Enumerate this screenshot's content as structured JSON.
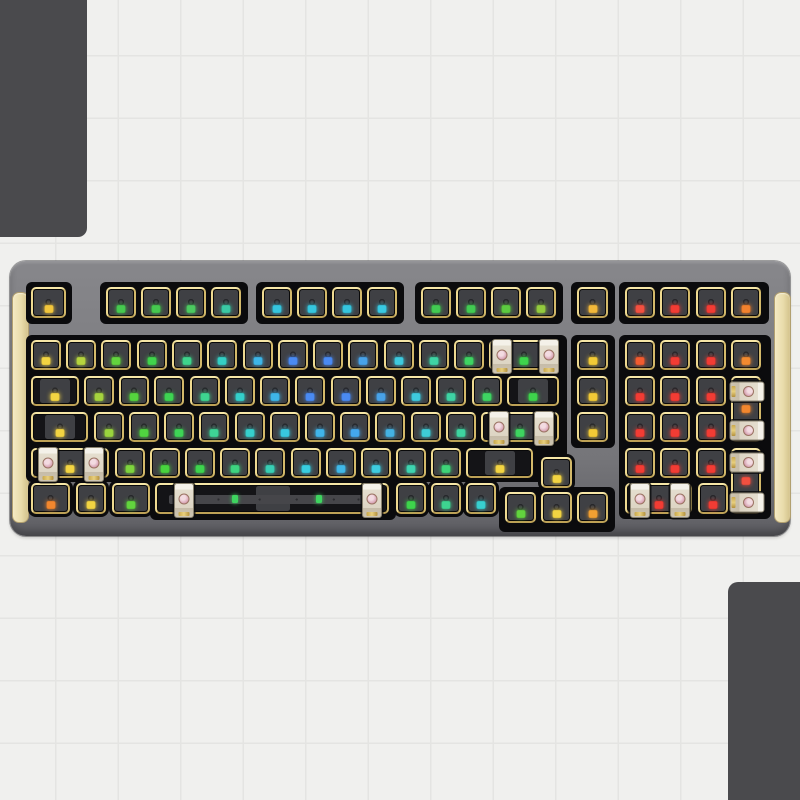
{
  "scene": {
    "background_color": "#f0f0ee",
    "grid_line_color": "#e4e4e2",
    "grid_size_px": 62.5,
    "grid_offset_px": 55,
    "corner_block_color": "#4a4a4d",
    "corner_blocks": [
      {
        "id": "top-left",
        "x": 0,
        "y": 0,
        "w": 87,
        "h": 237,
        "corner": "tl"
      },
      {
        "id": "bottom-right",
        "x": 728,
        "y": 582,
        "w": 72,
        "h": 218,
        "corner": "br"
      }
    ]
  },
  "keyboard": {
    "description": "barebone hot-swap keyboard kit, 98-key layout, gray case, gold plate, per-key RGB leds, stabilizers pre-installed",
    "x": 10,
    "y": 261,
    "w": 780,
    "h": 275,
    "case_color": "#7d7d81",
    "plate_gold_color": "#ead687",
    "pcb_black_color": "#0b0b0d",
    "switch_cutout_color": "#3f4044",
    "accent_color": "#e9dcab",
    "stabilizer_body_color": "#e5decf",
    "stabilizer_center_color": "#d49cae",
    "side_accents": [
      {
        "id": "left-side-accent",
        "x": 2,
        "y": 31,
        "w": 15,
        "h": 229
      },
      {
        "id": "right-side-accent",
        "x": 764,
        "y": 31,
        "w": 15,
        "h": 229
      }
    ],
    "pcb_panels": [
      {
        "x": 16,
        "y": 21,
        "w": 46,
        "h": 42
      },
      {
        "x": 90,
        "y": 21,
        "w": 148,
        "h": 42
      },
      {
        "x": 246,
        "y": 21,
        "w": 148,
        "h": 42
      },
      {
        "x": 405,
        "y": 21,
        "w": 148,
        "h": 42
      },
      {
        "x": 561,
        "y": 21,
        "w": 44,
        "h": 42
      },
      {
        "x": 609,
        "y": 21,
        "w": 150,
        "h": 42
      },
      {
        "x": 16,
        "y": 74,
        "w": 541,
        "h": 147
      },
      {
        "x": 561,
        "y": 74,
        "w": 44,
        "h": 113
      },
      {
        "x": 609,
        "y": 74,
        "w": 152,
        "h": 184
      },
      {
        "x": 140,
        "y": 217,
        "w": 246,
        "h": 42
      },
      {
        "x": 489,
        "y": 226,
        "w": 116,
        "h": 45
      }
    ],
    "keys": [
      {
        "id": "esc",
        "x": 21,
        "y": 26,
        "w": 36,
        "h": 32,
        "led": "#f2c63c",
        "t": "u"
      },
      {
        "id": "f1",
        "x": 96,
        "y": 26,
        "w": 31,
        "h": 32,
        "led": "#46c94f",
        "t": "u"
      },
      {
        "id": "f2",
        "x": 131,
        "y": 26,
        "w": 31,
        "h": 32,
        "led": "#46c94f",
        "t": "u"
      },
      {
        "id": "f3",
        "x": 166,
        "y": 26,
        "w": 31,
        "h": 32,
        "led": "#4cc960",
        "t": "u"
      },
      {
        "id": "f4",
        "x": 201,
        "y": 26,
        "w": 31,
        "h": 32,
        "led": "#3ac9a4",
        "t": "u"
      },
      {
        "id": "f5",
        "x": 252,
        "y": 26,
        "w": 31,
        "h": 32,
        "led": "#35c6de",
        "t": "u"
      },
      {
        "id": "f6",
        "x": 287,
        "y": 26,
        "w": 31,
        "h": 32,
        "led": "#35c6de",
        "t": "u"
      },
      {
        "id": "f7",
        "x": 322,
        "y": 26,
        "w": 31,
        "h": 32,
        "led": "#35c6de",
        "t": "u"
      },
      {
        "id": "f8",
        "x": 357,
        "y": 26,
        "w": 31,
        "h": 32,
        "led": "#38c9e2",
        "t": "u"
      },
      {
        "id": "f9",
        "x": 411,
        "y": 26,
        "w": 31,
        "h": 32,
        "led": "#42cb52",
        "t": "u"
      },
      {
        "id": "f10",
        "x": 446,
        "y": 26,
        "w": 31,
        "h": 32,
        "led": "#42cb52",
        "t": "u"
      },
      {
        "id": "f11",
        "x": 481,
        "y": 26,
        "w": 31,
        "h": 32,
        "led": "#5ccb40",
        "t": "u"
      },
      {
        "id": "f12",
        "x": 516,
        "y": 26,
        "w": 31,
        "h": 32,
        "led": "#93cb3e",
        "t": "u"
      },
      {
        "id": "nav-f",
        "x": 567,
        "y": 26,
        "w": 32,
        "h": 32,
        "led": "#f2b83a",
        "t": "u"
      },
      {
        "id": "numpad-f1",
        "x": 615,
        "y": 26,
        "w": 31,
        "h": 32,
        "led": "#f25040",
        "t": "u"
      },
      {
        "id": "numpad-f2",
        "x": 650,
        "y": 26,
        "w": 31,
        "h": 32,
        "led": "#f23c34",
        "t": "u"
      },
      {
        "id": "numpad-f3",
        "x": 686,
        "y": 26,
        "w": 31,
        "h": 32,
        "led": "#f23c34",
        "t": "u"
      },
      {
        "id": "numpad-f4",
        "x": 721,
        "y": 26,
        "w": 31,
        "h": 32,
        "led": "#f2822e",
        "t": "u"
      },
      {
        "id": "grave",
        "x": 21,
        "y": 79,
        "w": 31,
        "h": 31,
        "led": "#f2d442",
        "t": "u"
      },
      {
        "id": "1",
        "x": 56,
        "y": 79,
        "w": 31,
        "h": 31,
        "led": "#b5d43e",
        "t": "u"
      },
      {
        "id": "2",
        "x": 91,
        "y": 79,
        "w": 31,
        "h": 31,
        "led": "#62d43e",
        "t": "u"
      },
      {
        "id": "3",
        "x": 127,
        "y": 79,
        "w": 31,
        "h": 31,
        "led": "#40d44c",
        "t": "u"
      },
      {
        "id": "4",
        "x": 162,
        "y": 79,
        "w": 31,
        "h": 31,
        "led": "#3ed48c",
        "t": "u"
      },
      {
        "id": "5",
        "x": 197,
        "y": 79,
        "w": 31,
        "h": 31,
        "led": "#34cfc4",
        "t": "u"
      },
      {
        "id": "6",
        "x": 233,
        "y": 79,
        "w": 31,
        "h": 31,
        "led": "#3eb6e8",
        "t": "u"
      },
      {
        "id": "7",
        "x": 268,
        "y": 79,
        "w": 31,
        "h": 31,
        "led": "#4a8af2",
        "t": "u"
      },
      {
        "id": "8",
        "x": 303,
        "y": 79,
        "w": 31,
        "h": 31,
        "led": "#4a8af2",
        "t": "u"
      },
      {
        "id": "9",
        "x": 338,
        "y": 79,
        "w": 31,
        "h": 31,
        "led": "#48a2e8",
        "t": "u"
      },
      {
        "id": "0",
        "x": 374,
        "y": 79,
        "w": 31,
        "h": 31,
        "led": "#3ecade",
        "t": "u"
      },
      {
        "id": "minus",
        "x": 409,
        "y": 79,
        "w": 31,
        "h": 31,
        "led": "#3ed4a4",
        "t": "u"
      },
      {
        "id": "equal",
        "x": 444,
        "y": 79,
        "w": 31,
        "h": 31,
        "led": "#3ed462",
        "t": "u"
      },
      {
        "id": "backspace",
        "x": 479,
        "y": 79,
        "w": 71,
        "h": 31,
        "led": "#3ed44c",
        "t": "wide"
      },
      {
        "id": "nav-1",
        "x": 567,
        "y": 79,
        "w": 32,
        "h": 31,
        "led": "#f2ca36",
        "t": "u"
      },
      {
        "id": "numpad-lock",
        "x": 615,
        "y": 79,
        "w": 31,
        "h": 31,
        "led": "#f25c30",
        "t": "u"
      },
      {
        "id": "numpad-div",
        "x": 650,
        "y": 79,
        "w": 31,
        "h": 31,
        "led": "#f23c34",
        "t": "u"
      },
      {
        "id": "numpad-mul",
        "x": 686,
        "y": 79,
        "w": 31,
        "h": 31,
        "led": "#f23c34",
        "t": "u"
      },
      {
        "id": "numpad-minus",
        "x": 721,
        "y": 79,
        "w": 31,
        "h": 31,
        "led": "#f28a30",
        "t": "u"
      },
      {
        "id": "tab",
        "x": 21,
        "y": 115,
        "w": 49,
        "h": 31,
        "led": "#f2d442",
        "t": "wide"
      },
      {
        "id": "q",
        "x": 74,
        "y": 115,
        "w": 31,
        "h": 31,
        "led": "#a6d43e",
        "t": "u"
      },
      {
        "id": "w",
        "x": 109,
        "y": 115,
        "w": 31,
        "h": 31,
        "led": "#55d43e",
        "t": "u"
      },
      {
        "id": "e",
        "x": 144,
        "y": 115,
        "w": 31,
        "h": 31,
        "led": "#3ed452",
        "t": "u"
      },
      {
        "id": "r",
        "x": 180,
        "y": 115,
        "w": 31,
        "h": 31,
        "led": "#3ed490",
        "t": "u"
      },
      {
        "id": "t",
        "x": 215,
        "y": 115,
        "w": 31,
        "h": 31,
        "led": "#34cfca",
        "t": "u"
      },
      {
        "id": "y",
        "x": 250,
        "y": 115,
        "w": 31,
        "h": 31,
        "led": "#3eb6e8",
        "t": "u"
      },
      {
        "id": "u",
        "x": 285,
        "y": 115,
        "w": 31,
        "h": 31,
        "led": "#4a8af2",
        "t": "u"
      },
      {
        "id": "i",
        "x": 321,
        "y": 115,
        "w": 31,
        "h": 31,
        "led": "#4a8af2",
        "t": "u"
      },
      {
        "id": "o",
        "x": 356,
        "y": 115,
        "w": 31,
        "h": 31,
        "led": "#48a2e8",
        "t": "u"
      },
      {
        "id": "p",
        "x": 391,
        "y": 115,
        "w": 31,
        "h": 31,
        "led": "#3ecade",
        "t": "u"
      },
      {
        "id": "lbracket",
        "x": 426,
        "y": 115,
        "w": 31,
        "h": 31,
        "led": "#3ed4a4",
        "t": "u"
      },
      {
        "id": "rbracket",
        "x": 462,
        "y": 115,
        "w": 31,
        "h": 31,
        "led": "#3ed462",
        "t": "u"
      },
      {
        "id": "backslash",
        "x": 497,
        "y": 115,
        "w": 53,
        "h": 31,
        "led": "#3ed44c",
        "t": "wide"
      },
      {
        "id": "nav-2",
        "x": 567,
        "y": 115,
        "w": 32,
        "h": 31,
        "led": "#f2ca36",
        "t": "u"
      },
      {
        "id": "numpad-7",
        "x": 615,
        "y": 115,
        "w": 31,
        "h": 31,
        "led": "#f23c34",
        "t": "u"
      },
      {
        "id": "numpad-8",
        "x": 650,
        "y": 115,
        "w": 31,
        "h": 31,
        "led": "#f23c34",
        "t": "u"
      },
      {
        "id": "numpad-9",
        "x": 686,
        "y": 115,
        "w": 31,
        "h": 31,
        "led": "#f23c34",
        "t": "u"
      },
      {
        "id": "numpad-plus",
        "x": 721,
        "y": 115,
        "w": 31,
        "h": 67,
        "led": "#f2872e",
        "t": "tall"
      },
      {
        "id": "caps",
        "x": 21,
        "y": 151,
        "w": 58,
        "h": 31,
        "led": "#f2d442",
        "t": "wide"
      },
      {
        "id": "a",
        "x": 84,
        "y": 151,
        "w": 31,
        "h": 31,
        "led": "#9ad43e",
        "t": "u"
      },
      {
        "id": "s",
        "x": 119,
        "y": 151,
        "w": 31,
        "h": 31,
        "led": "#50d440",
        "t": "u"
      },
      {
        "id": "d",
        "x": 154,
        "y": 151,
        "w": 31,
        "h": 31,
        "led": "#3ed456",
        "t": "u"
      },
      {
        "id": "f",
        "x": 189,
        "y": 151,
        "w": 31,
        "h": 31,
        "led": "#3ed496",
        "t": "u"
      },
      {
        "id": "g",
        "x": 225,
        "y": 151,
        "w": 31,
        "h": 31,
        "led": "#36cfcc",
        "t": "u"
      },
      {
        "id": "h",
        "x": 260,
        "y": 151,
        "w": 31,
        "h": 31,
        "led": "#38c8e0",
        "t": "u"
      },
      {
        "id": "j",
        "x": 295,
        "y": 151,
        "w": 31,
        "h": 31,
        "led": "#40b4ea",
        "t": "u"
      },
      {
        "id": "k",
        "x": 330,
        "y": 151,
        "w": 31,
        "h": 31,
        "led": "#44a8ee",
        "t": "u"
      },
      {
        "id": "l",
        "x": 365,
        "y": 151,
        "w": 31,
        "h": 31,
        "led": "#44b2e2",
        "t": "u"
      },
      {
        "id": "semicolon",
        "x": 401,
        "y": 151,
        "w": 31,
        "h": 31,
        "led": "#3eccd6",
        "t": "u"
      },
      {
        "id": "quote",
        "x": 436,
        "y": 151,
        "w": 31,
        "h": 31,
        "led": "#3ed4a0",
        "t": "u"
      },
      {
        "id": "enter",
        "x": 471,
        "y": 151,
        "w": 79,
        "h": 31,
        "led": "#3ed460",
        "t": "wide"
      },
      {
        "id": "nav-3",
        "x": 567,
        "y": 151,
        "w": 32,
        "h": 31,
        "led": "#f2ca36",
        "t": "u"
      },
      {
        "id": "numpad-4",
        "x": 615,
        "y": 151,
        "w": 31,
        "h": 31,
        "led": "#f23c34",
        "t": "u"
      },
      {
        "id": "numpad-5",
        "x": 650,
        "y": 151,
        "w": 31,
        "h": 31,
        "led": "#f23c34",
        "t": "u"
      },
      {
        "id": "numpad-6",
        "x": 686,
        "y": 151,
        "w": 31,
        "h": 31,
        "led": "#f23c34",
        "t": "u"
      },
      {
        "id": "lshift",
        "x": 21,
        "y": 187,
        "w": 79,
        "h": 31,
        "led": "#f2d442",
        "t": "wide"
      },
      {
        "id": "z",
        "x": 105,
        "y": 187,
        "w": 31,
        "h": 31,
        "led": "#7ed43e",
        "t": "u"
      },
      {
        "id": "x",
        "x": 140,
        "y": 187,
        "w": 31,
        "h": 31,
        "led": "#48d43e",
        "t": "u"
      },
      {
        "id": "c",
        "x": 175,
        "y": 187,
        "w": 31,
        "h": 31,
        "led": "#3ed44e",
        "t": "u"
      },
      {
        "id": "v",
        "x": 210,
        "y": 187,
        "w": 31,
        "h": 31,
        "led": "#3ed480",
        "t": "u"
      },
      {
        "id": "b",
        "x": 245,
        "y": 187,
        "w": 31,
        "h": 31,
        "led": "#38cfb4",
        "t": "u"
      },
      {
        "id": "n",
        "x": 281,
        "y": 187,
        "w": 31,
        "h": 31,
        "led": "#38cde0",
        "t": "u"
      },
      {
        "id": "m",
        "x": 316,
        "y": 187,
        "w": 31,
        "h": 31,
        "led": "#40b8e8",
        "t": "u"
      },
      {
        "id": "comma",
        "x": 351,
        "y": 187,
        "w": 31,
        "h": 31,
        "led": "#3ecce0",
        "t": "u"
      },
      {
        "id": "period",
        "x": 386,
        "y": 187,
        "w": 31,
        "h": 31,
        "led": "#3ed4b0",
        "t": "u"
      },
      {
        "id": "slash",
        "x": 421,
        "y": 187,
        "w": 31,
        "h": 31,
        "led": "#3ed478",
        "t": "u"
      },
      {
        "id": "rshift",
        "x": 456,
        "y": 187,
        "w": 68,
        "h": 31,
        "led": "#f2d442",
        "t": "wide"
      },
      {
        "id": "arrow-up",
        "x": 531,
        "y": 196,
        "w": 32,
        "h": 32,
        "led": "#f2d442",
        "t": "u"
      },
      {
        "id": "numpad-1",
        "x": 615,
        "y": 187,
        "w": 31,
        "h": 31,
        "led": "#f23c34",
        "t": "u"
      },
      {
        "id": "numpad-2",
        "x": 650,
        "y": 187,
        "w": 31,
        "h": 31,
        "led": "#f23c34",
        "t": "u"
      },
      {
        "id": "numpad-3",
        "x": 686,
        "y": 187,
        "w": 31,
        "h": 31,
        "led": "#f23c34",
        "t": "u"
      },
      {
        "id": "numpad-enter",
        "x": 721,
        "y": 187,
        "w": 31,
        "h": 67,
        "led": "#f25040",
        "t": "tall"
      },
      {
        "id": "lctrl",
        "x": 21,
        "y": 222,
        "w": 40,
        "h": 32,
        "led": "#f2872e",
        "t": "u"
      },
      {
        "id": "lwin",
        "x": 66,
        "y": 222,
        "w": 31,
        "h": 32,
        "led": "#f2d442",
        "t": "u"
      },
      {
        "id": "lalt",
        "x": 102,
        "y": 222,
        "w": 39,
        "h": 32,
        "led": "#62d43e",
        "t": "u"
      },
      {
        "id": "space",
        "x": 145,
        "y": 222,
        "w": 235,
        "h": 32,
        "led": null,
        "t": "space"
      },
      {
        "id": "ralt",
        "x": 386,
        "y": 222,
        "w": 31,
        "h": 32,
        "led": "#3ed44c",
        "t": "u"
      },
      {
        "id": "fn",
        "x": 421,
        "y": 222,
        "w": 31,
        "h": 32,
        "led": "#3ed490",
        "t": "u"
      },
      {
        "id": "rctrl",
        "x": 456,
        "y": 222,
        "w": 31,
        "h": 32,
        "led": "#38cfd0",
        "t": "u"
      },
      {
        "id": "arrow-left",
        "x": 495,
        "y": 231,
        "w": 32,
        "h": 32,
        "led": "#62d43e",
        "t": "u"
      },
      {
        "id": "arrow-down",
        "x": 531,
        "y": 231,
        "w": 32,
        "h": 32,
        "led": "#f2d442",
        "t": "u"
      },
      {
        "id": "arrow-right",
        "x": 567,
        "y": 231,
        "w": 32,
        "h": 32,
        "led": "#f2a032",
        "t": "u"
      },
      {
        "id": "numpad-0",
        "x": 615,
        "y": 222,
        "w": 68,
        "h": 32,
        "led": "#f23c34",
        "t": "wide"
      },
      {
        "id": "numpad-dot",
        "x": 688,
        "y": 222,
        "w": 31,
        "h": 32,
        "led": "#f23c34",
        "t": "u"
      }
    ],
    "space_leds": {
      "color": "#3ed45f",
      "offsets": [
        78,
        162
      ]
    },
    "stabilizers": [
      {
        "key": "backspace",
        "cx": 491,
        "cy": 94,
        "o": "v"
      },
      {
        "key": "backspace",
        "cx": 538,
        "cy": 94,
        "o": "v"
      },
      {
        "key": "enter",
        "cx": 488,
        "cy": 166,
        "o": "v"
      },
      {
        "key": "enter",
        "cx": 533,
        "cy": 166,
        "o": "v"
      },
      {
        "key": "lshift",
        "cx": 37,
        "cy": 202,
        "o": "v"
      },
      {
        "key": "lshift",
        "cx": 83,
        "cy": 202,
        "o": "v"
      },
      {
        "key": "space",
        "cx": 173,
        "cy": 238,
        "o": "v"
      },
      {
        "key": "space",
        "cx": 361,
        "cy": 238,
        "o": "v"
      },
      {
        "key": "numpad-0",
        "cx": 629,
        "cy": 238,
        "o": "v"
      },
      {
        "key": "numpad-0",
        "cx": 669,
        "cy": 238,
        "o": "v"
      },
      {
        "key": "numpad-plus",
        "cx": 736,
        "cy": 129,
        "o": "h"
      },
      {
        "key": "numpad-plus",
        "cx": 736,
        "cy": 168,
        "o": "h"
      },
      {
        "key": "numpad-enter",
        "cx": 736,
        "cy": 200,
        "o": "h"
      },
      {
        "key": "numpad-enter",
        "cx": 736,
        "cy": 240,
        "o": "h"
      }
    ]
  }
}
